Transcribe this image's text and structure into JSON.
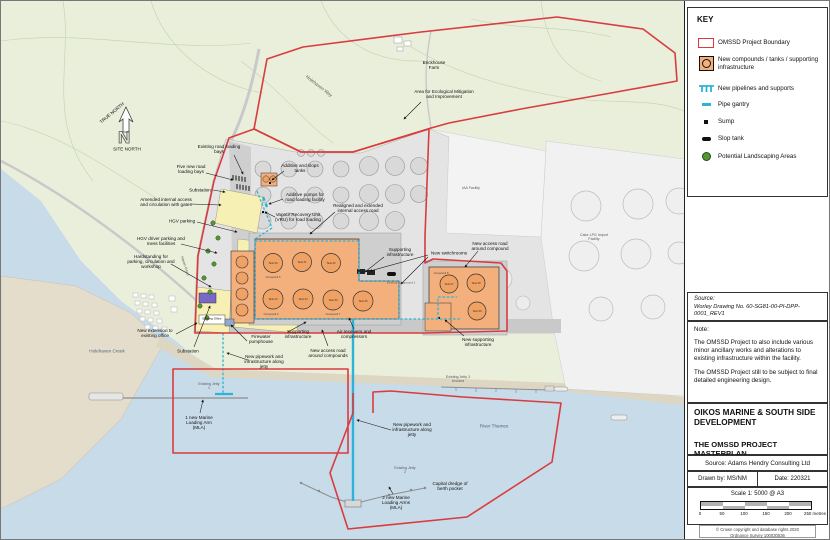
{
  "colors": {
    "boundary_red": "#d93b3f",
    "pipeline_cyan": "#2db3d8",
    "compound_orange": "#f3b07c",
    "tank_orange": "#f0a264",
    "landscaping_green": "#55962f",
    "field_green": "#e9efdb",
    "water_blue": "#c8dbe9",
    "marsh_tan": "#e5ddcc",
    "facility_gray": "#e4e4e4",
    "new_area_yellow": "#f7f0b4",
    "substation_purple": "#7a68c6"
  },
  "key": {
    "title": "KEY",
    "items": [
      {
        "label": "OMSSD Project Boundary"
      },
      {
        "label": "New compounds / tanks / supporting infrastructure"
      },
      {
        "label": "New pipelines and supports"
      },
      {
        "label": "Pipe gantry"
      },
      {
        "label": "Sump"
      },
      {
        "label": "Slop tank"
      },
      {
        "label": "Potential Landscaping Areas"
      }
    ]
  },
  "source_box": {
    "heading": "Source:",
    "text": "Worley Drawing No. 60-SG81-00-PI-DPP-0001_REV1"
  },
  "note_box": {
    "heading": "Note:",
    "para1": "The OMSSD Project to also include various minor ancillary works and alterations to existing infrastructure within the facility.",
    "para2": "The OMSSD Project still to be subject to final detailed engineering design."
  },
  "title_block": {
    "project_title": "OIKOS MARINE & SOUTH SIDE DEVELOPMENT",
    "drawing_title": "THE OMSSD PROJECT MASTERPLAN",
    "source": "Source: Adams Hendry Consulting Ltd",
    "drawn_by": "Drawn by: MS/NM",
    "date": "Date: 220321",
    "scale": "Scale 1: 5000 @ A3",
    "scale_ticks": [
      "0",
      "50",
      "100",
      "150",
      "200",
      "250 metres"
    ],
    "copyright1": "© Crown copyright and database rights 2020",
    "copyright2": "Ordnance Survey 100030536"
  },
  "compass": {
    "true_north": "TRUE NORTH",
    "site_north": "SITE NORTH",
    "n": "N"
  },
  "map": {
    "labels": [
      "Brickhouse Farm",
      "Area for Ecological Mitigation and Improvement",
      "Holehaven Way",
      "Existing road loading bays",
      "Five new road loading bays",
      "Substation",
      "Amended internal access and circulation with gates",
      "HGV parking",
      "HGV driver parking and mess facilities",
      "Hardstanding for parking, circulation and workshop",
      "Additive and slops tanks",
      "Additive pumps for road loading facility",
      "Vapour Recovery Unit (VRU) for road loading",
      "Realigned and extended internal access road",
      "New switchrooms",
      "IAA Facility",
      "Calor LPG Import Facility",
      "New access road around compound",
      "Supporting infrastructure",
      "New extension to existing office",
      "Existing Office",
      "Substation",
      "Firewater pumphouse",
      "Supporting infrastructure",
      "New access road around compounds",
      "Air receivers and compressors",
      "New pipework and infrastructure along jetty",
      "Holehaven Creek",
      "Existing Jetty 1",
      "1 new Marine Loading Arm (MLA)",
      "New pipework and infrastructure along jetty",
      "Existing Jetty 2",
      "2 new Marine Loading Arms (MLA)",
      "Capital dredge of berth pocket",
      "Existing Jetty 3 Unused",
      "River Thames",
      "New supporting infrastructure",
      "Existing Compound 1",
      "Haven Road"
    ],
    "tanks": [
      "Tank 60",
      "Tank 61",
      "Tank 62",
      "Tank 63",
      "Tank 64",
      "Tank 65",
      "Tank 66",
      "Tank 67",
      "Tank 68",
      "Tank 69"
    ],
    "compounds": [
      "Compound 5",
      "Compound 6",
      "Compound 7",
      "Compound 8"
    ]
  }
}
